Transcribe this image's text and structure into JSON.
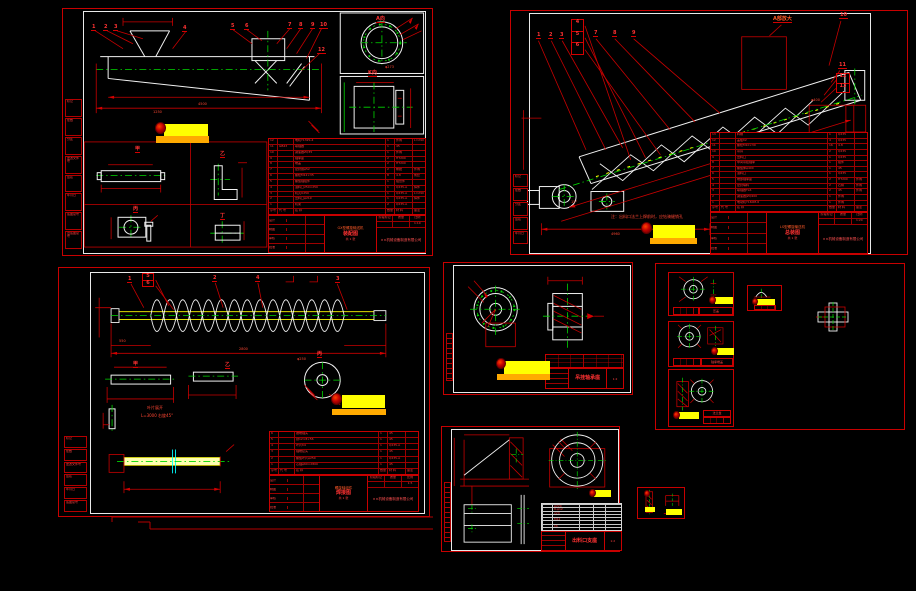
{
  "canvas": {
    "bg": "#000000"
  },
  "palette": {
    "frame_red": "#c80000",
    "dim_red": "#ff3232",
    "geometry_white": "#f2f2f2",
    "center_green": "#00d800",
    "helix_yellow": "#ffff00",
    "pale_yellow": "#ffffb0",
    "section_cyan": "#00ffff",
    "stamp_yellow": "#ffff00",
    "stamp_orange": "#ffaa00"
  },
  "company": "××机械设备制造有限公司",
  "title_labels": [
    "设计",
    "制图",
    "审核",
    "批准"
  ],
  "minigrid": [
    "阶段标记",
    "质量",
    "比例"
  ],
  "margin_labels": [
    "标记",
    "处数",
    "分区",
    "更改文件号",
    "签名",
    "年月日",
    "底图总号",
    "旧底图总号"
  ],
  "sheet_a": {
    "callouts": [
      "1",
      "2",
      "3",
      "4",
      "5",
      "6",
      "7",
      "8",
      "9",
      "10",
      "12"
    ],
    "view_labels": {
      "flange": "A向",
      "side": "K向",
      "d1": "甲",
      "d2": "乙",
      "d3": "丙",
      "d4": "丁"
    },
    "dims": [
      "4500",
      "1250",
      "φ273"
    ],
    "bom_rows": [
      [
        "12",
        "",
        "电机Y132S-4",
        "1",
        "外购",
        "L=290"
      ],
      [
        "11",
        "GB43",
        "联轴器",
        "1",
        "45",
        ""
      ],
      [
        "10",
        "",
        "减速器ZQ35",
        "1",
        "外购",
        ""
      ],
      [
        "9",
        "",
        "轴承座",
        "2",
        "HT200",
        ""
      ],
      [
        "8",
        "",
        "端盖",
        "2",
        "HT200",
        ""
      ],
      [
        "7",
        "",
        "密封圈φ52",
        "2",
        "橡胶",
        "外购"
      ],
      [
        "6",
        "",
        "螺栓M12×35",
        "8",
        "4.8",
        "成套"
      ],
      [
        "5",
        "",
        "螺旋轴组件",
        "1",
        "组合件",
        ""
      ],
      [
        "4",
        "",
        "进料口250×250",
        "1",
        "Q235-A",
        "焊件"
      ],
      [
        "3",
        "",
        "机壳U250",
        "1",
        "Q235-A",
        "L=290"
      ],
      [
        "2",
        "",
        "出料口φ219",
        "1",
        "Q235-A",
        "焊件"
      ],
      [
        "1",
        "",
        "机架",
        "2",
        "Q235-A",
        ""
      ],
      [
        "序号",
        "代 号",
        "名  称",
        "数量",
        "材 料",
        "备注"
      ]
    ],
    "title": {
      "t1": "GX型螺旋输送机",
      "t2": "装配图",
      "scale": "1:10",
      "count": "共 1 张"
    }
  },
  "sheet_b": {
    "callouts": [
      "1",
      "2",
      "3",
      "4",
      "5",
      "6",
      "7",
      "8",
      "9",
      "10",
      "11",
      "12",
      "13"
    ],
    "detail_label": "A部放大",
    "note": "注：出料口法兰上焊前时，应钻骑缝销孔",
    "dims": [
      "4960",
      "15°",
      "φ400"
    ],
    "bom_rows": [
      [
        "13",
        "",
        "料槽",
        "1",
        "Q235",
        ""
      ],
      [
        "12",
        "",
        "盖板δ2",
        "4",
        "Q235",
        ""
      ],
      [
        "11",
        "",
        "螺栓M10×30",
        "16",
        "4.8",
        ""
      ],
      [
        "10",
        "",
        "吊耳",
        "2",
        "Q235",
        ""
      ],
      [
        "9",
        "",
        "出料口",
        "1",
        "Q235",
        ""
      ],
      [
        "8",
        "",
        "中间吊挂轴承",
        "1",
        "组件",
        ""
      ],
      [
        "7",
        "",
        "螺旋体φ400",
        "1",
        "45",
        ""
      ],
      [
        "6",
        "",
        "进料口",
        "1",
        "Q235",
        ""
      ],
      [
        "5",
        "",
        "端部轴承座",
        "2",
        "HT200",
        "外购"
      ],
      [
        "4",
        "",
        "密封填料",
        "2",
        "石棉",
        "外购"
      ],
      [
        "3",
        "",
        "联轴器TL6",
        "2",
        "45",
        "外购"
      ],
      [
        "2",
        "",
        "减速器JZQ400",
        "1",
        "外购",
        ""
      ],
      [
        "1",
        "",
        "电动机Y160M-6",
        "1",
        "外购",
        ""
      ],
      [
        "序号",
        "代 号",
        "名  称",
        "数量",
        "材 料",
        "备注"
      ]
    ],
    "title": {
      "t1": "LS型螺旋输送机",
      "t2": "总装图",
      "scale": "1:20",
      "count": "共 1 张"
    }
  },
  "sheet_c": {
    "callouts": [
      "1",
      "2",
      "3",
      "4",
      "5",
      "6"
    ],
    "view_labels": {
      "d1": "甲",
      "d2": "乙",
      "d3": "丙"
    },
    "notes": [
      "叶片展开",
      "L=3000 右旋45°"
    ],
    "dims": [
      "2800",
      "550",
      "φ250"
    ],
    "bom_rows": [
      [
        "6",
        "",
        "锥端轴头",
        "1",
        "45",
        ""
      ],
      [
        "5",
        "",
        "键12×8×56",
        "1",
        "45",
        ""
      ],
      [
        "4",
        "",
        "叶片δ4",
        "1",
        "Q235-A",
        ""
      ],
      [
        "3",
        "",
        "轴端接头",
        "1",
        "45",
        ""
      ],
      [
        "2",
        "",
        "螺旋叶片φ250",
        "1",
        "Q235-A",
        ""
      ],
      [
        "1",
        "",
        "芯轴φ60×2800",
        "1",
        "45",
        ""
      ],
      [
        "序号",
        "代 号",
        "名  称",
        "数量",
        "材 料",
        "备注"
      ]
    ],
    "title": {
      "t1": "螺旋轴组件",
      "t2": "焊接图",
      "scale": "1:5",
      "count": "共 1 张"
    }
  },
  "sheet_d": {
    "title": {
      "t2": "吊挂轴承座",
      "scale": "1:2"
    }
  },
  "sheet_e": {
    "e1": "压盖",
    "e2": "轴承端盖",
    "e3": "法兰盘",
    "etop": "垫圈"
  },
  "sheet_f": {
    "title": {
      "t2": "出料口支座",
      "scale": "1:2"
    },
    "table_rows": [
      [
        "",
        "φ220",
        "",
        "",
        ""
      ],
      [
        "",
        "8-φ12",
        "",
        "",
        ""
      ],
      [
        "",
        "220",
        "",
        "",
        ""
      ],
      [
        "",
        "",
        "",
        "",
        ""
      ],
      [
        "",
        "M12",
        "",
        "",
        ""
      ],
      [
        "",
        "",
        "",
        "",
        ""
      ],
      [
        "",
        "δ6",
        "",
        "",
        ""
      ],
      [
        "",
        "",
        "",
        "",
        ""
      ]
    ]
  }
}
